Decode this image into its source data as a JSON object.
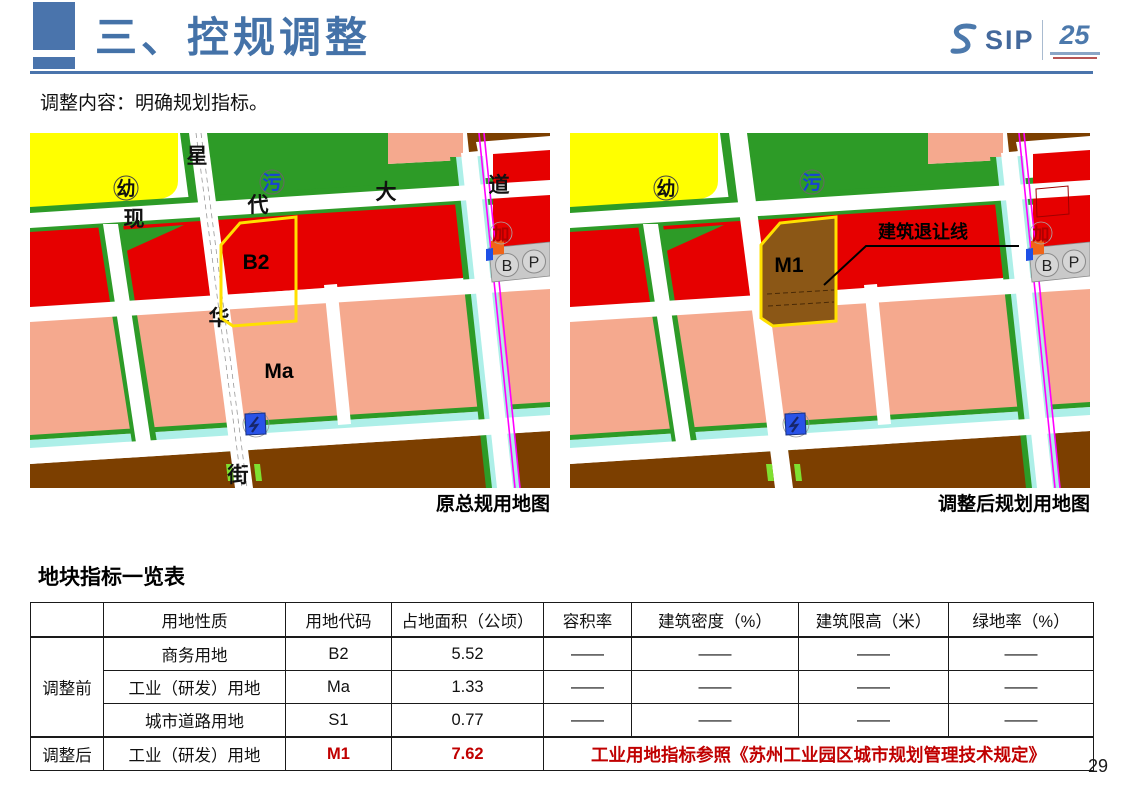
{
  "header": {
    "title": "三、控规调整",
    "logo_text": "SIP",
    "logo_anniversary": "25"
  },
  "subtitle": "调整内容：明确规划指标。",
  "page_number": "29",
  "maps": {
    "colors": {
      "commercial_red": "#E60000",
      "industrial_pink": "#F5A98E",
      "green_space": "#2D9B27",
      "kindergarten_yellow": "#FFFF00",
      "warehouse_brown": "#7C3F00",
      "m1_brown": "#8B5716",
      "canal_cyan": "#ADEFE8",
      "metro_magenta": "#FF00FF",
      "parcel_outline_yellow": "#FFE000",
      "highlight_red": "#C00000"
    },
    "before": {
      "caption": "原总规用地图",
      "parcel_label": "B2",
      "area_label": "Ma",
      "road_chars": [
        "星",
        "现",
        "代",
        "大",
        "道",
        "华",
        "街"
      ],
      "poi": {
        "kindergarten": "幼",
        "sewage": "污",
        "gas": "加",
        "b": "B",
        "p": "P"
      }
    },
    "after": {
      "caption": "调整后规划用地图",
      "parcel_label": "M1",
      "annotation": "建筑退让线",
      "poi": {
        "kindergarten": "幼",
        "sewage": "污",
        "gas": "加",
        "b": "B",
        "p": "P"
      }
    }
  },
  "table": {
    "title": "地块指标一览表",
    "headers": [
      "",
      "用地性质",
      "用地代码",
      "占地面积（公顷）",
      "容积率",
      "建筑密度（%）",
      "建筑限高（米）",
      "绿地率（%）"
    ],
    "groups": [
      {
        "label": "调整前",
        "rows": [
          {
            "nature": "商务用地",
            "code": "B2",
            "area": "5.52",
            "far": "——",
            "density": "——",
            "height": "——",
            "green": "——"
          },
          {
            "nature": "工业（研发）用地",
            "code": "Ma",
            "area": "1.33",
            "far": "——",
            "density": "——",
            "height": "——",
            "green": "——"
          },
          {
            "nature": "城市道路用地",
            "code": "S1",
            "area": "0.77",
            "far": "——",
            "density": "——",
            "height": "——",
            "green": "——"
          }
        ]
      },
      {
        "label": "调整后",
        "rows": [
          {
            "nature": "工业（研发）用地",
            "code": "M1",
            "area": "7.62",
            "highlight": true
          }
        ],
        "note": "工业用地指标参照《苏州工业园区城市规划管理技术规定》"
      }
    ]
  }
}
